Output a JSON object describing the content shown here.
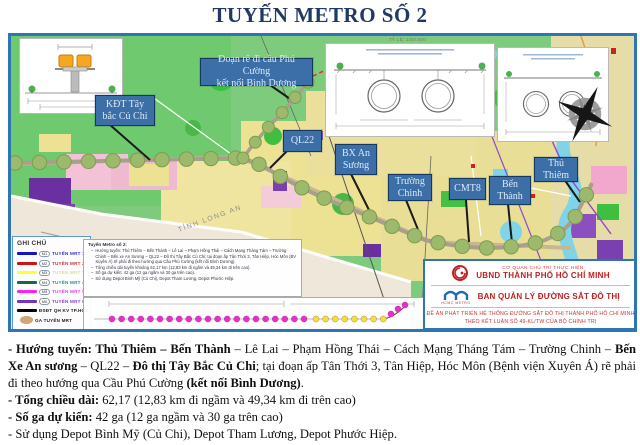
{
  "title": "TUYẾN METRO SỐ 2",
  "map": {
    "scale_note": "TỶ LỆ: 1/50.000",
    "long_an_label": "TỈNH LONG AN",
    "labels": {
      "kdt": "KĐT Tây\nbắc Củ Chi",
      "doan_re": "Đoạn rẽ đi cầu Phú Cường\nkết nối Bình Dương",
      "ql22": "QL22",
      "bx_an_suong": "BX An\nSương",
      "truong_chinh": "Trường\nChinh",
      "cmt8": "CMT8",
      "ben_thanh": "Bến\nThành",
      "thu_thiem": "Thủ\nThiêm"
    },
    "legend": {
      "title": "GHI CHÚ",
      "items": [
        {
          "badge": "M1",
          "label": "TUYẾN MRT 1",
          "color": "#1414CC",
          "text_color": "#3333CC",
          "shape": "line"
        },
        {
          "badge": "M2",
          "label": "TUYẾN MRT 2",
          "color": "#CC1414",
          "text_color": "#CC3333",
          "shape": "line"
        },
        {
          "badge": "M3",
          "label": "TUYẾN MRT 3",
          "color": "#FFFF33",
          "text_color": "#DDDD99",
          "shape": "line"
        },
        {
          "badge": "M4",
          "label": "TUYẾN MRT 4",
          "color": "#156B45",
          "text_color": "#2F8F8F",
          "shape": "line"
        },
        {
          "badge": "M5",
          "label": "TUYẾN MRT 5",
          "color": "#FF22FF",
          "text_color": "#DD44DD",
          "shape": "line"
        },
        {
          "badge": "M6",
          "label": "TUYẾN MRT 6",
          "color": "#7733BB",
          "text_color": "#8844CC",
          "shape": "line"
        },
        {
          "badge": "",
          "label": "ĐSĐT QH KV TP.HCM",
          "color": "#000000",
          "text_color": "#222222",
          "shape": "line"
        },
        {
          "badge": "",
          "label": "GA TUYẾN MRT",
          "color": "#D2A478",
          "text_color": "#222222",
          "shape": "ellipse"
        }
      ]
    },
    "note_box": {
      "title": "Tuyến Metro số 2:",
      "lines": [
        "Hướng tuyến: Thủ Thiêm – Bến Thành – Lê Lai – Phạm Hồng Thái – Cách Mạng Tháng Tám – Trường Chinh – Bến xe An Sương – QL22 – Đô thị Tây Bắc Củ Chi; tại đoạn ấp Tân Thới 3, Tân Hiệp, Hóc Môn (BV Xuyên Á) rẽ phải đi theo hướng qua Cầu Phú Cường (kết nối Bình Dương).",
        "Tổng chiều dài tuyến khoảng 62,17 km (12,83 km đi ngầm và 49,34 km đi trên cao).",
        "Số ga dự kiến: 42 ga (12 ga ngầm và 30 ga trên cao).",
        "Sử dụng Depot Bình Mỹ (Củ Chi), Depot Tham Lương, Depot Phước Hiệp."
      ]
    },
    "info_box": {
      "agency_small": "CƠ QUAN CHỦ TRÌ THỰC HIỆN",
      "agency": "UBND THÀNH PHỐ HỒ CHÍ MINH",
      "metro_logo_text": "HCMC METRO",
      "board": "BAN QUẢN LÝ ĐƯỜNG SẮT ĐÔ THỊ",
      "project_line1": "ĐỀ ÁN PHÁT TRIỂN HỆ THỐNG ĐƯỜNG SẮT ĐÔ THỊ THÀNH PHỐ HỒ CHÍ MINH",
      "project_line2": "THEO KẾT LUẬN SỐ 49-KL/TW CỦA BỘ CHÍNH TRỊ"
    }
  },
  "description": {
    "p1": [
      {
        "t": "- Hướng tuyến: Thủ Thiêm – Bến Thành",
        "b": true
      },
      {
        "t": " – Lê Lai – Phạm Hồng Thái – Cách Mạng Tháng Tám – Trường Chinh – ",
        "b": false
      },
      {
        "t": "Bến Xe An sương",
        "b": true
      },
      {
        "t": " – QL22 – ",
        "b": false
      },
      {
        "t": "Đô thị Tây Bắc Củ Chi",
        "b": true
      },
      {
        "t": "; tại đoạn ấp Tân Thới 3, Tân Hiệp, Hóc Môn (Bệnh viện Xuyên Á) rẽ phải đi theo hướng qua Cầu Phú Cường ",
        "b": false
      },
      {
        "t": "(kết nối Bình Dương)",
        "b": true
      },
      {
        "t": ".",
        "b": false
      }
    ],
    "p2": [
      {
        "t": "- Tổng chiều dài:",
        "b": true
      },
      {
        "t": " 62,17 (12,83 km đi ngầm và 49,34 km đi trên cao)",
        "b": false
      }
    ],
    "p3": [
      {
        "t": "- Số ga dự kiến:",
        "b": true
      },
      {
        "t": " 42 ga (12 ga ngầm và 30 ga trên cao)",
        "b": false
      }
    ],
    "p4": [
      {
        "t": "- Sử dụng Depot Bình Mỹ (Củ Chi), Depot Tham Lương, Depot Phước Hiệp.",
        "b": false
      }
    ]
  },
  "colors": {
    "accent_blue": "#2E75B6",
    "title_navy": "#1F3864",
    "label_box": "#3C6FA8",
    "station_green": "#9CB96C",
    "info_red": "#C02020"
  }
}
